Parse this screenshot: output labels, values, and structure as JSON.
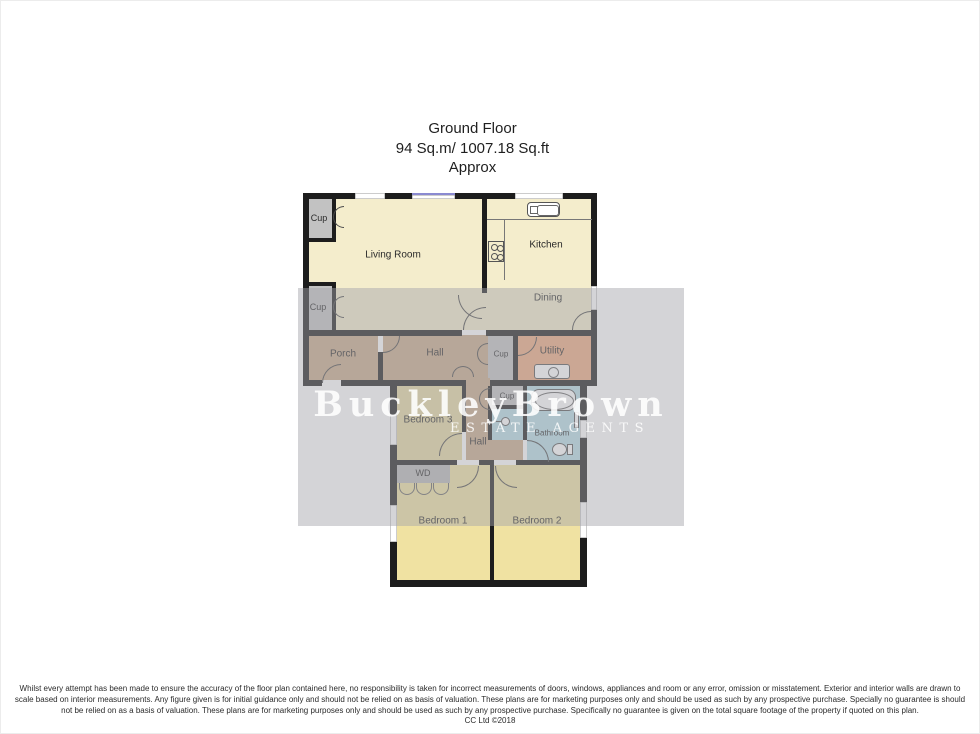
{
  "title": {
    "line1": "Ground Floor",
    "line2": "94 Sq.m/ 1007.18 Sq.ft",
    "line3": "Approx"
  },
  "watermark": {
    "name": "BuckleyBrown",
    "tagline": "ESTATE AGENTS"
  },
  "rooms": {
    "living_room": "Living Room",
    "kitchen": "Kitchen",
    "dining": "Dining",
    "porch": "Porch",
    "hall_upper": "Hall",
    "hall_lower": "Hall",
    "cup_a": "Cup",
    "cup_b": "Cup",
    "cup_c": "Cup",
    "cup_d": "Cup",
    "utility": "Utility",
    "bedroom_1": "Bedroom 1",
    "bedroom_2": "Bedroom 2",
    "bedroom_3": "Bedroom 3",
    "bathroom": "Bathroom",
    "wd": "WD"
  },
  "disclaimer": {
    "line1": "Whilst every attempt has been made to ensure the accuracy of the floor plan contained here, no responsibility is taken for incorrect measurements of doors, windows, appliances and room or any error, omission or misstatement. Exterior and interior walls are drawn to",
    "line2": "scale based on interior measurements. Any figure given is for initial guidance only and should not be relied on as basis of valuation. These plans are for marketing purposes only and should be used as such by any prospective purchase. Specially no guarantee is should",
    "line3": "not be relied on as a basis of valuation. These plans are for marketing purposes only and should be used as such by any prospective purchase. Specifically no guarantee is given on the total square footage of the property if quoted on this plan.",
    "line4": "CC Ltd ©2018"
  },
  "colors": {
    "wall": "#1d1d1d",
    "living_kitchen": "#f4edcc",
    "hall_porch": "#c9ab8b",
    "utility": "#eeab80",
    "bathroom": "#b7dde7",
    "bedroom": "#f0e2a2",
    "bedroom_3": "#e7daa2",
    "cupboard": "#c2c2c2",
    "wardrobe": "#b9b9b9",
    "watermark_band": "#d4d4d7",
    "watermark_text": "#ffffff",
    "window_glazing_blue": "#8a8ad0"
  }
}
